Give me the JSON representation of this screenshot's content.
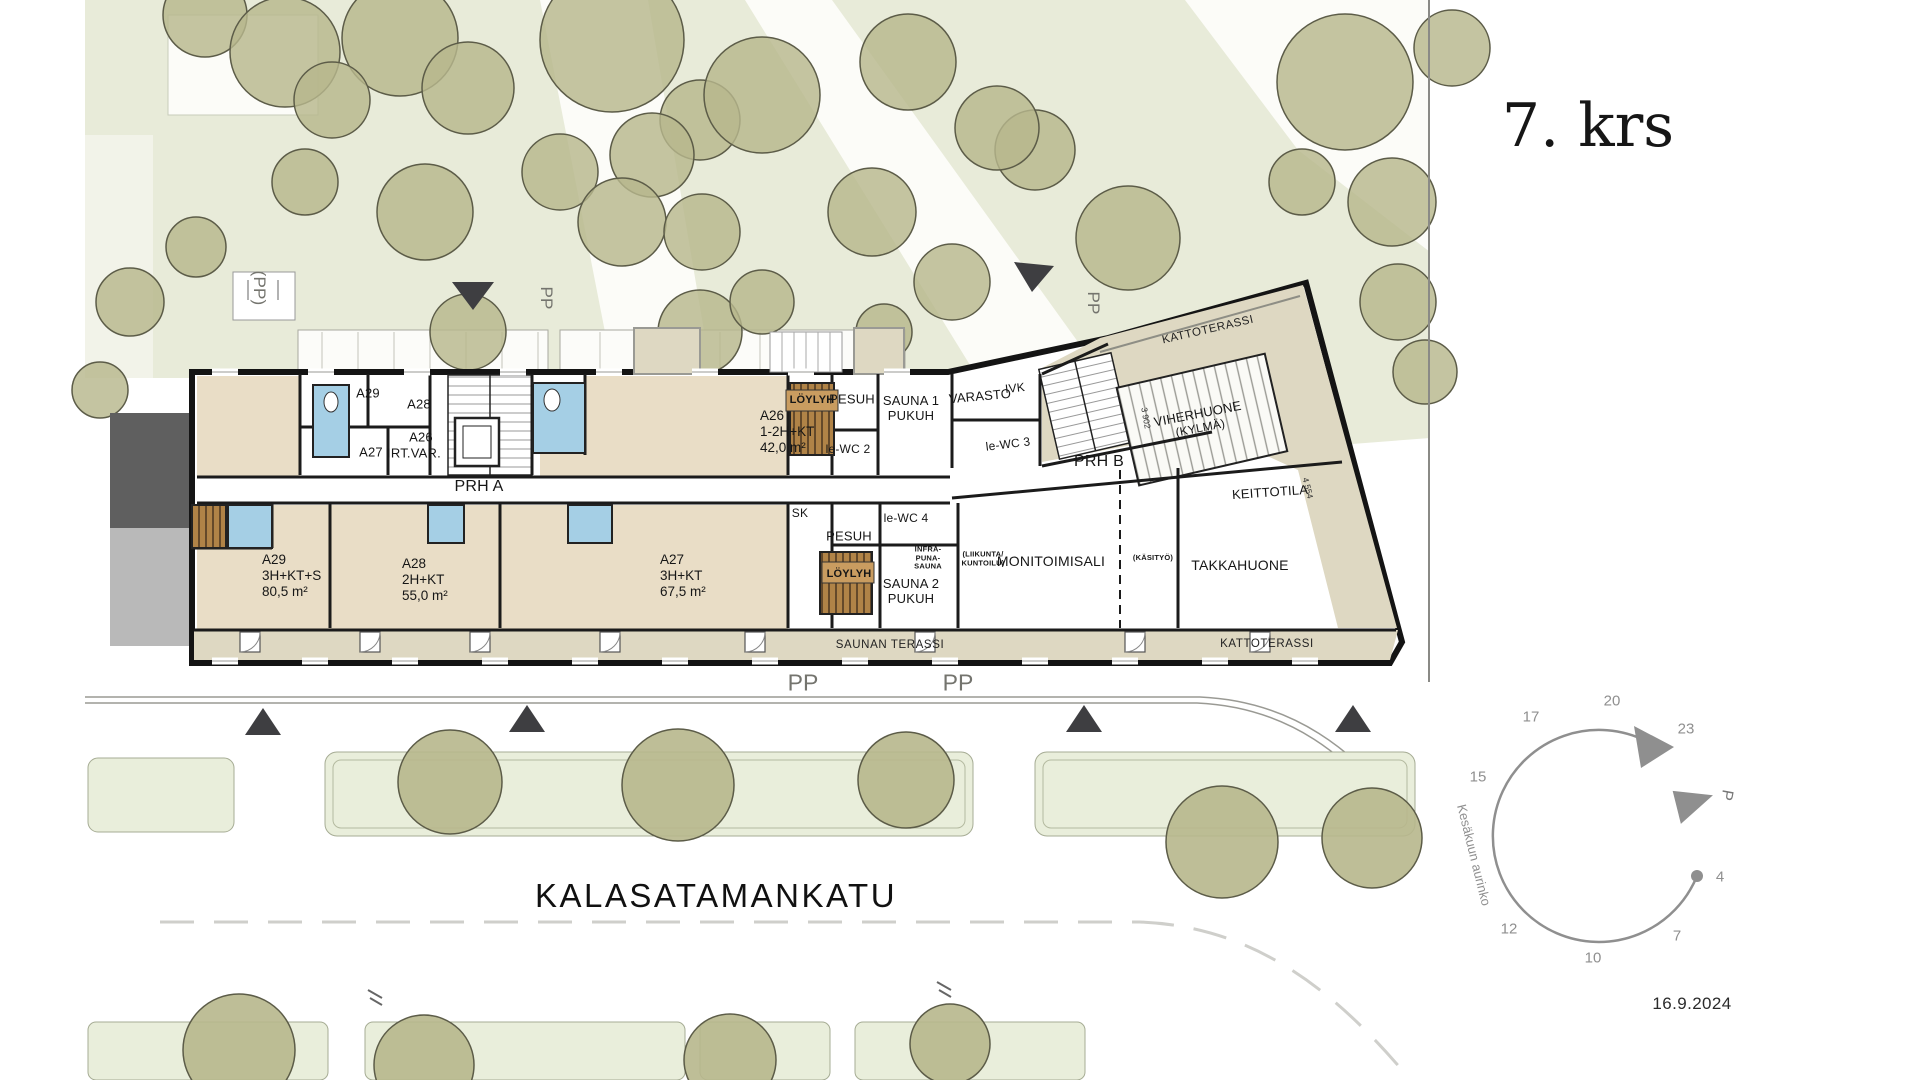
{
  "panel": {
    "title": "7. krs",
    "date": "16.9.2024"
  },
  "street": {
    "name": "KALASATAMANKATU",
    "pp_left": "PP",
    "pp_right": "PP"
  },
  "site": {
    "pp_parking_1": "(PP)",
    "pp_parking_2": "PP",
    "pp_parking_3": "PP"
  },
  "plan": {
    "corridors": {
      "prh_a": "PRH A",
      "prh_b": "PRH B"
    },
    "storage": {
      "a29": "A29",
      "a28": "A28",
      "a26": "A26",
      "a27": "A27",
      "irt_var": "IRT.VAR."
    },
    "apartments": {
      "a26": {
        "id": "A26",
        "type": "1-2H+KT",
        "area": "42,0 m²"
      },
      "a29": {
        "id": "A29",
        "type": "3H+KT+S",
        "area": "80,5 m²"
      },
      "a28": {
        "id": "A28",
        "type": "2H+KT",
        "area": "55,0 m²"
      },
      "a27": {
        "id": "A27",
        "type": "3H+KT",
        "area": "67,5 m²"
      }
    },
    "sauna1": {
      "loylyh": "LÖYLYH",
      "pesuh": "PESUH",
      "name1": "SAUNA 1",
      "name2": "PUKUH",
      "wc": "le-WC 2"
    },
    "sauna2": {
      "loylyh": "LÖYLYH",
      "pesuh": "PESUH",
      "name1": "SAUNA 2",
      "name2": "PUKUH",
      "wc": "le-WC 4",
      "sk": "SK",
      "infra1": "INFRA-",
      "infra2": "PUNA-",
      "infra3": "SAUNA"
    },
    "common": {
      "varasto": "VARASTO",
      "ivk": "IVK",
      "wc3": "le-WC 3",
      "viher1": "VIHERHUONE",
      "viher2": "(KYLMÄ)",
      "keittotila": "KEITTOTILA",
      "monitoimisali": "MONITOIMISALI",
      "liikunta1": "(LIIKUNTA/",
      "liikunta2": "KUNTOILU)",
      "kasityo": "(KÄSITYÖ)",
      "takkahuone": "TAKKAHUONE"
    },
    "terraces": {
      "katto_top": "KATTOTERASSI",
      "katto_bottom": "KATTOTERASSI",
      "saunan_terassi": "SAUNAN TERASSI"
    },
    "dimensions": {
      "d1": "4 554",
      "d2": "3 902"
    }
  },
  "sun": {
    "h4": "4",
    "h7": "7",
    "h10": "10",
    "h12": "12",
    "h15": "15",
    "h17": "17",
    "h20": "20",
    "h23": "23",
    "caption": "Kesäkuun aurinko",
    "north": "P"
  },
  "colors": {
    "park_green": "#e8ebd9",
    "tree_olive": "#b7b78c",
    "apartment_beige": "#e9ddc6",
    "terrace_beige": "#ded8c2",
    "wet_blue": "#a5cfe5",
    "sauna_wood": "#b08347",
    "wall_black": "#141414",
    "sun_gray": "#8f8f8f"
  }
}
